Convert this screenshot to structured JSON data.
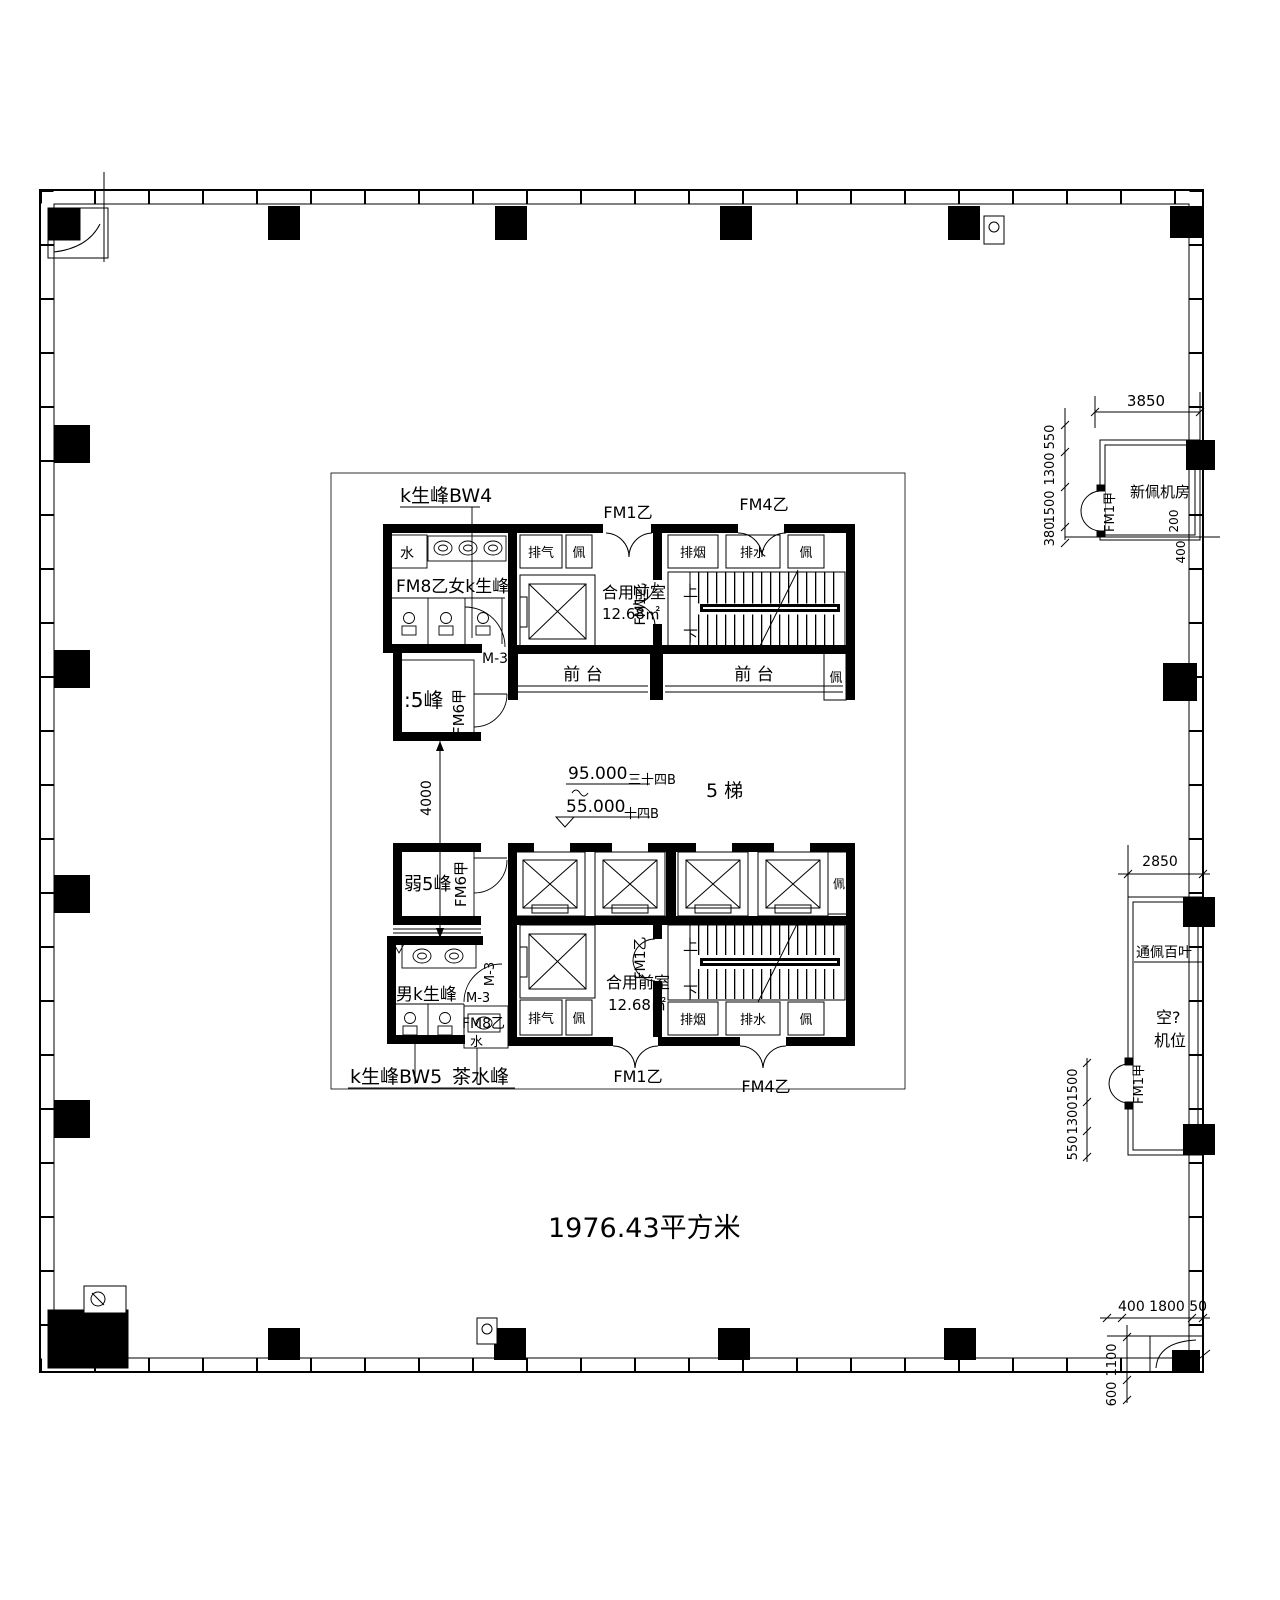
{
  "labels": {
    "toilet_bw4": "k生峰BW4",
    "toilet_bw5": "k生峰BW5",
    "women_toilet": "FM8乙女k生峰",
    "men_toilet": "男k生峰",
    "tea_room": "茶水峰",
    "water": "水",
    "door_m3": "M-3",
    "room_5feng": ":5峰",
    "weak_5feng": "弱5峰",
    "door_fm6a": "FM6甲",
    "door_fm8b": "FM8乙",
    "door_fm1b": "FM1乙",
    "door_fm4b": "FM4乙",
    "door_fm1a": "FM1甲",
    "exhaust": "排气",
    "smoke_vent": "排烟",
    "drain": "排水",
    "pei": "佩",
    "vestibule": "合用前室",
    "vestibule_area": "12.68㎡",
    "front_desk": "前 台",
    "up": "上",
    "down": "下",
    "elev_high": "95.000",
    "elev_high_floor": "三十四B",
    "elev_low": "55.000",
    "elev_low_floor": "十四B",
    "stair_count": "5 梯",
    "fresh_air_room": "新佩机房",
    "louver": "通佩百叶",
    "ac_line1": "空?",
    "ac_line2": "机位",
    "total_area": "1976.43平方米"
  },
  "dims": {
    "d4000": "4000",
    "d3850": "3850",
    "d550": "550",
    "d1300": "1300",
    "d1500": "1500",
    "d380": "380",
    "d200": "200",
    "d400": "400",
    "d2850": "2850",
    "d400_1800_50": "400 1800 50",
    "d1100": "1100",
    "d600": "600"
  }
}
